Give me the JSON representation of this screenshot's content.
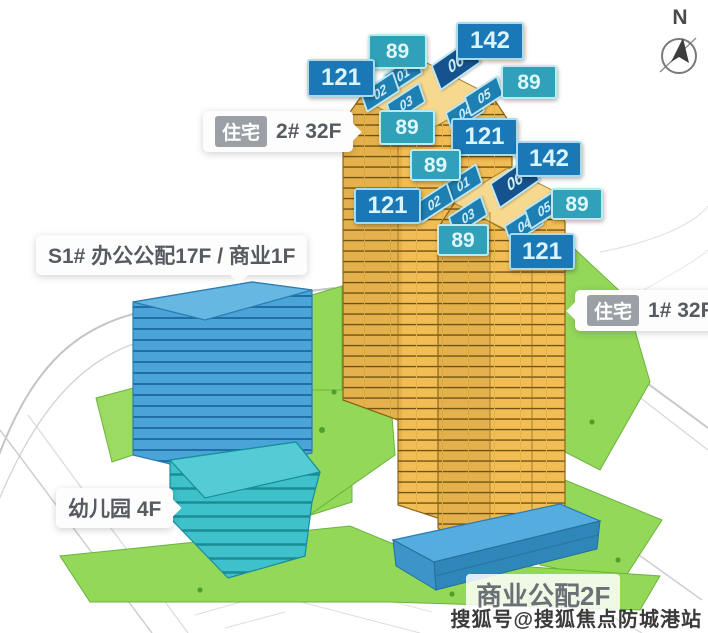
{
  "compass": {
    "label": "N"
  },
  "buildings": {
    "tower2": {
      "tag": "住宅",
      "label": "2# 32F"
    },
    "tower1": {
      "tag": "住宅",
      "label": "1# 32F"
    },
    "office": {
      "label": "S1# 办公公配17F / 商业1F"
    },
    "kindergarten": {
      "label": "幼儿园 4F"
    },
    "commercial": {
      "label": "商业公配2F"
    }
  },
  "tower2": {
    "areas": {
      "tl": "89",
      "tr": "142",
      "left": "121",
      "right": "89",
      "bottom": "89",
      "br": "121"
    },
    "units": {
      "u1": "01",
      "u2": "02",
      "u3": "03",
      "u4": "04",
      "u5": "05",
      "u6": "06"
    }
  },
  "tower1": {
    "areas": {
      "tl": "89",
      "tr": "142",
      "left": "121",
      "right": "89",
      "bottom": "89",
      "br": "121"
    },
    "units": {
      "u1": "01",
      "u2": "02",
      "u3": "03",
      "u4": "04",
      "u5": "05",
      "u6": "06"
    }
  },
  "watermark": "搜狐号@搜狐焦点防城港站",
  "colors": {
    "area_badge_blue": "#1978b5",
    "area_badge_teal": "#31a1ba",
    "unit_badge_blue": "#1e7fb2",
    "unit_badge_dark": "#16528e",
    "tower_yellow": "#f3bf58",
    "office_blue": "#4aa4d8",
    "kindergarten_teal": "#3ec1ca",
    "commercial_blue": "#55acdf",
    "lawn_green": "#94d85a"
  }
}
